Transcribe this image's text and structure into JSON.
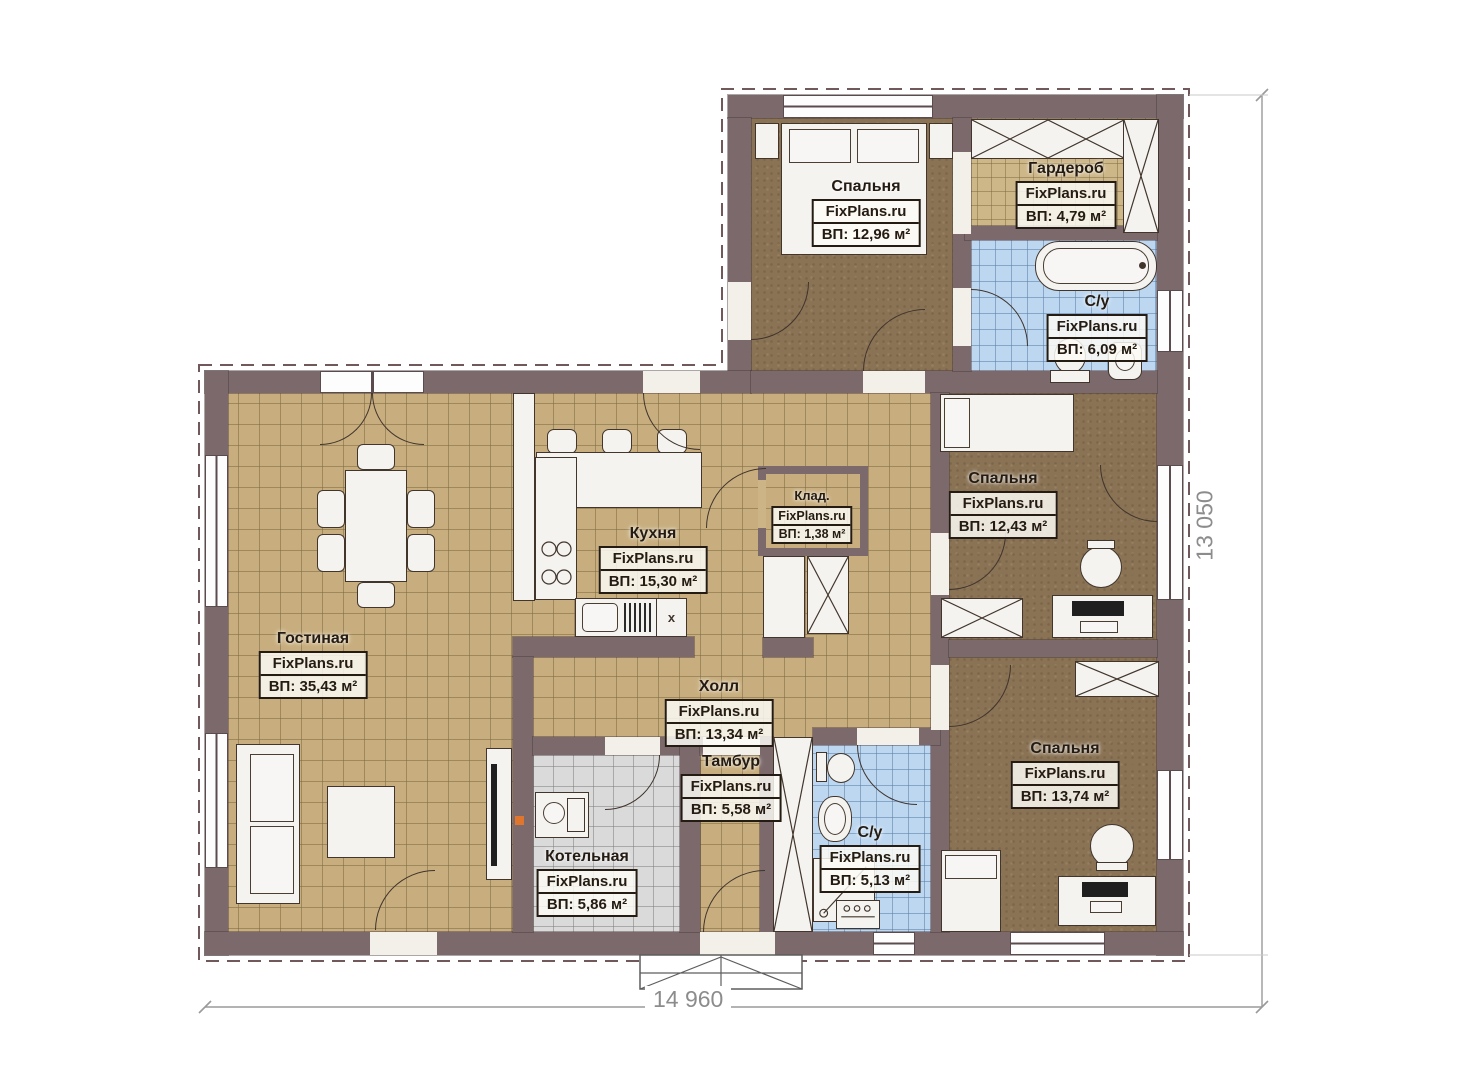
{
  "site": {
    "watermark": "FixPlans.ru"
  },
  "dimensions": {
    "width_label": "14 960",
    "height_label": "13 050"
  },
  "rooms": {
    "bedroom_top": {
      "name": "Спальня",
      "wm": "FixPlans.ru",
      "area": "ВП: 12,96 м²"
    },
    "wardrobe": {
      "name": "Гардероб",
      "wm": "FixPlans.ru",
      "area": "ВП: 4,79 м²"
    },
    "bath_top": {
      "name": "С/у",
      "wm": "FixPlans.ru",
      "area": "ВП: 6,09 м²"
    },
    "bedroom_mid": {
      "name": "Спальня",
      "wm": "FixPlans.ru",
      "area": "ВП: 12,43 м²"
    },
    "kitchen": {
      "name": "Кухня",
      "wm": "FixPlans.ru",
      "area": "ВП: 15,30 м²"
    },
    "storage": {
      "name": "Клад.",
      "wm": "FixPlans.ru",
      "area": "ВП: 1,38 м²"
    },
    "living": {
      "name": "Гостиная",
      "wm": "FixPlans.ru",
      "area": "ВП: 35,43 м²"
    },
    "hall": {
      "name": "Холл",
      "wm": "FixPlans.ru",
      "area": "ВП: 13,34 м²"
    },
    "vestibule": {
      "name": "Тамбур",
      "wm": "FixPlans.ru",
      "area": "ВП: 5,58 м²"
    },
    "boiler": {
      "name": "Котельная",
      "wm": "FixPlans.ru",
      "area": "ВП: 5,86 м²"
    },
    "bath_bottom": {
      "name": "С/у",
      "wm": "FixPlans.ru",
      "area": "ВП: 5,13 м²"
    },
    "bedroom_bottom": {
      "name": "Спальня",
      "wm": "FixPlans.ru",
      "area": "ВП: 13,74 м²"
    }
  },
  "kitchen_marks": {
    "dishwasher": "x"
  },
  "colors": {
    "wall": "#7c696b",
    "tile_floor": "#c8ae7e",
    "wood_floor": "#8a7254",
    "bath_floor": "#bdd7f1",
    "boiler_floor": "#dadada",
    "furniture": "#f4f3f0",
    "accent_socket": "#e0762e",
    "dimension_text": "#8c8c8c"
  }
}
